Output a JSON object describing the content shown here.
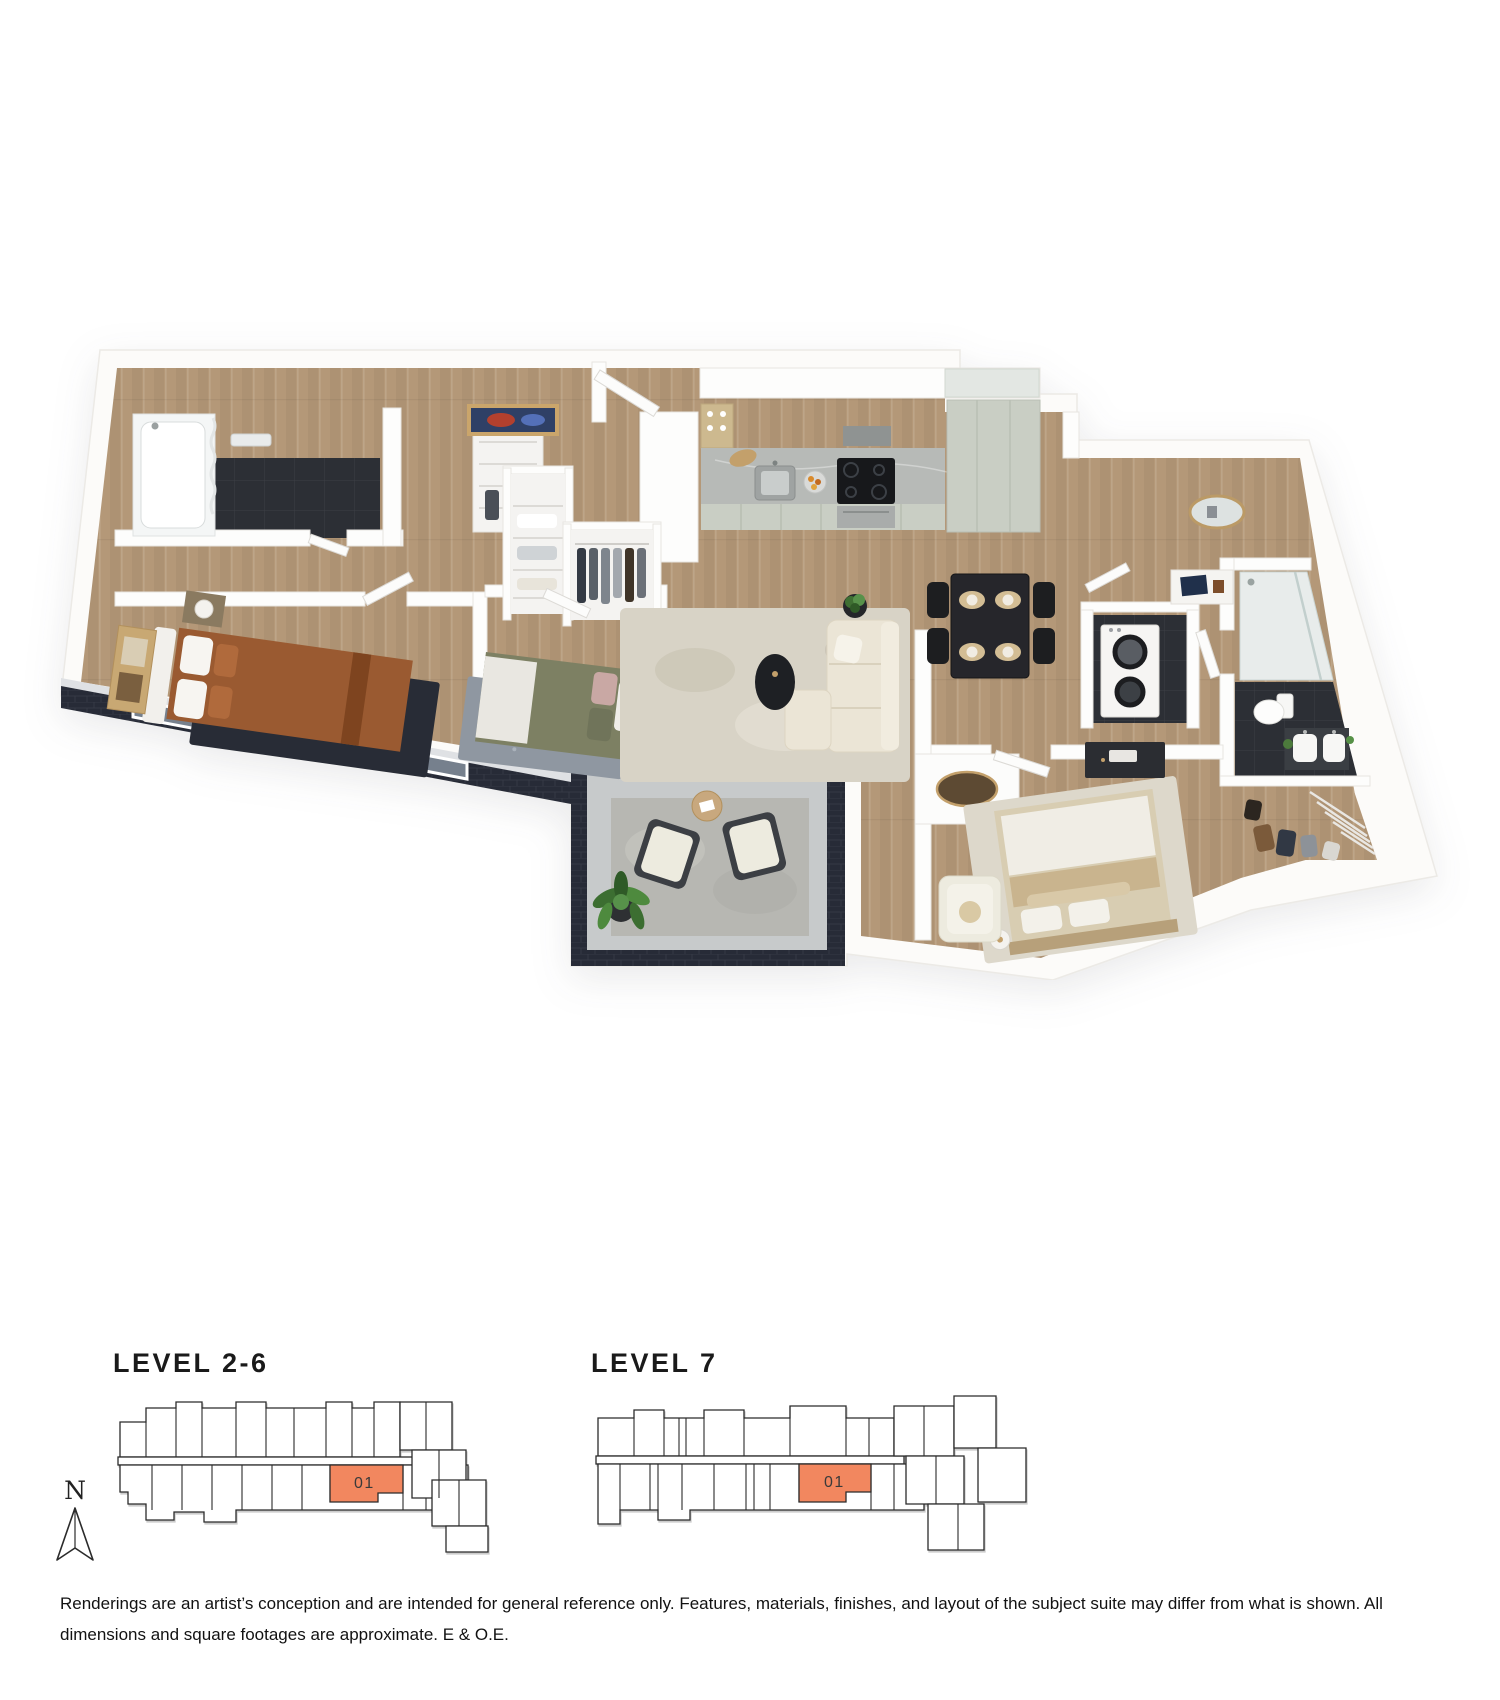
{
  "palette": {
    "accent_orange": "#F2875F",
    "keyplan_line": "#2B2B2B",
    "wood_floor": "#B49878",
    "dark_tile": "#2C2F35",
    "exterior_brick_navy": "#272B37",
    "cabinet_sage": "#C9CEC4",
    "balcony_concrete": "#C7CACB",
    "heading_text": "#1A1A1A",
    "body_text": "#111111"
  },
  "levels": [
    {
      "label": "LEVEL 2-6",
      "unit_label": "01"
    },
    {
      "label": "LEVEL 7",
      "unit_label": "01"
    }
  ],
  "compass": {
    "label": "N"
  },
  "disclaimer": "Renderings are an artist’s conception and are intended for general reference only. Features, materials, finishes, and layout of the subject suite may differ from what is shown. All dimensions and square footages are approximate. E & O.E."
}
